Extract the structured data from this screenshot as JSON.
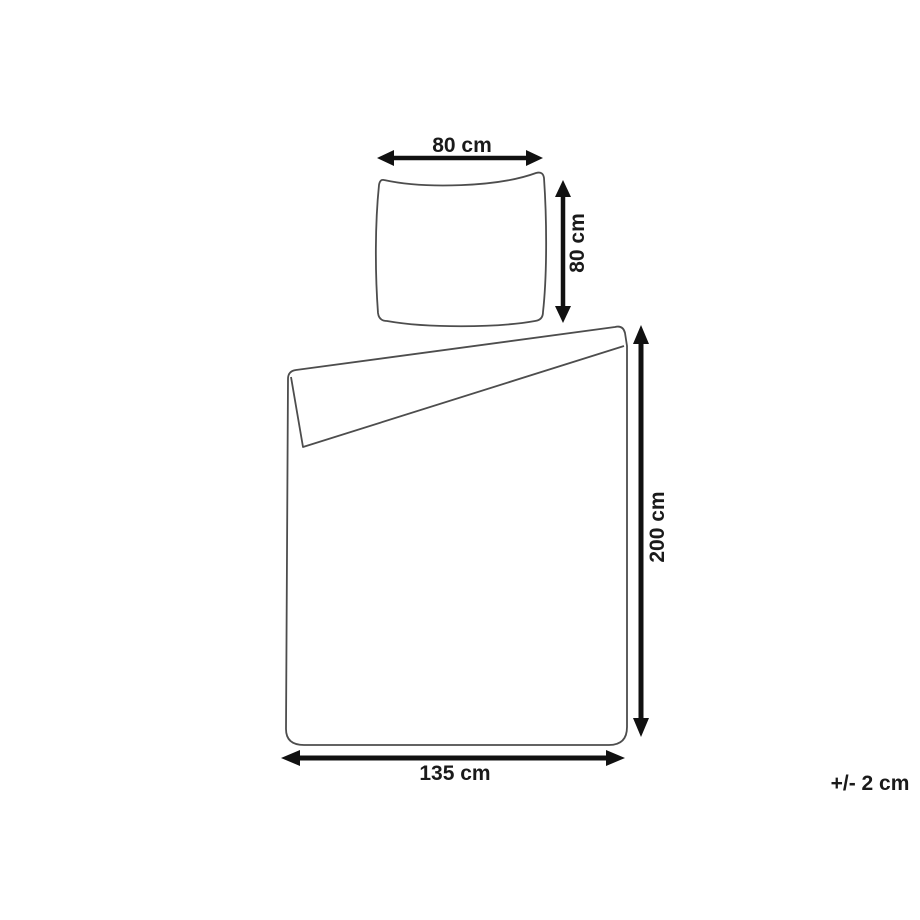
{
  "diagram": {
    "labels": {
      "pillow_width": "80 cm",
      "pillow_height": "80 cm",
      "duvet_height": "200 cm",
      "duvet_width": "135 cm",
      "tolerance": "+/- 2 cm"
    },
    "colors": {
      "outline": "#4d4d4d",
      "arrow": "#111111",
      "text": "#1a1a1a",
      "background": "#ffffff"
    }
  }
}
